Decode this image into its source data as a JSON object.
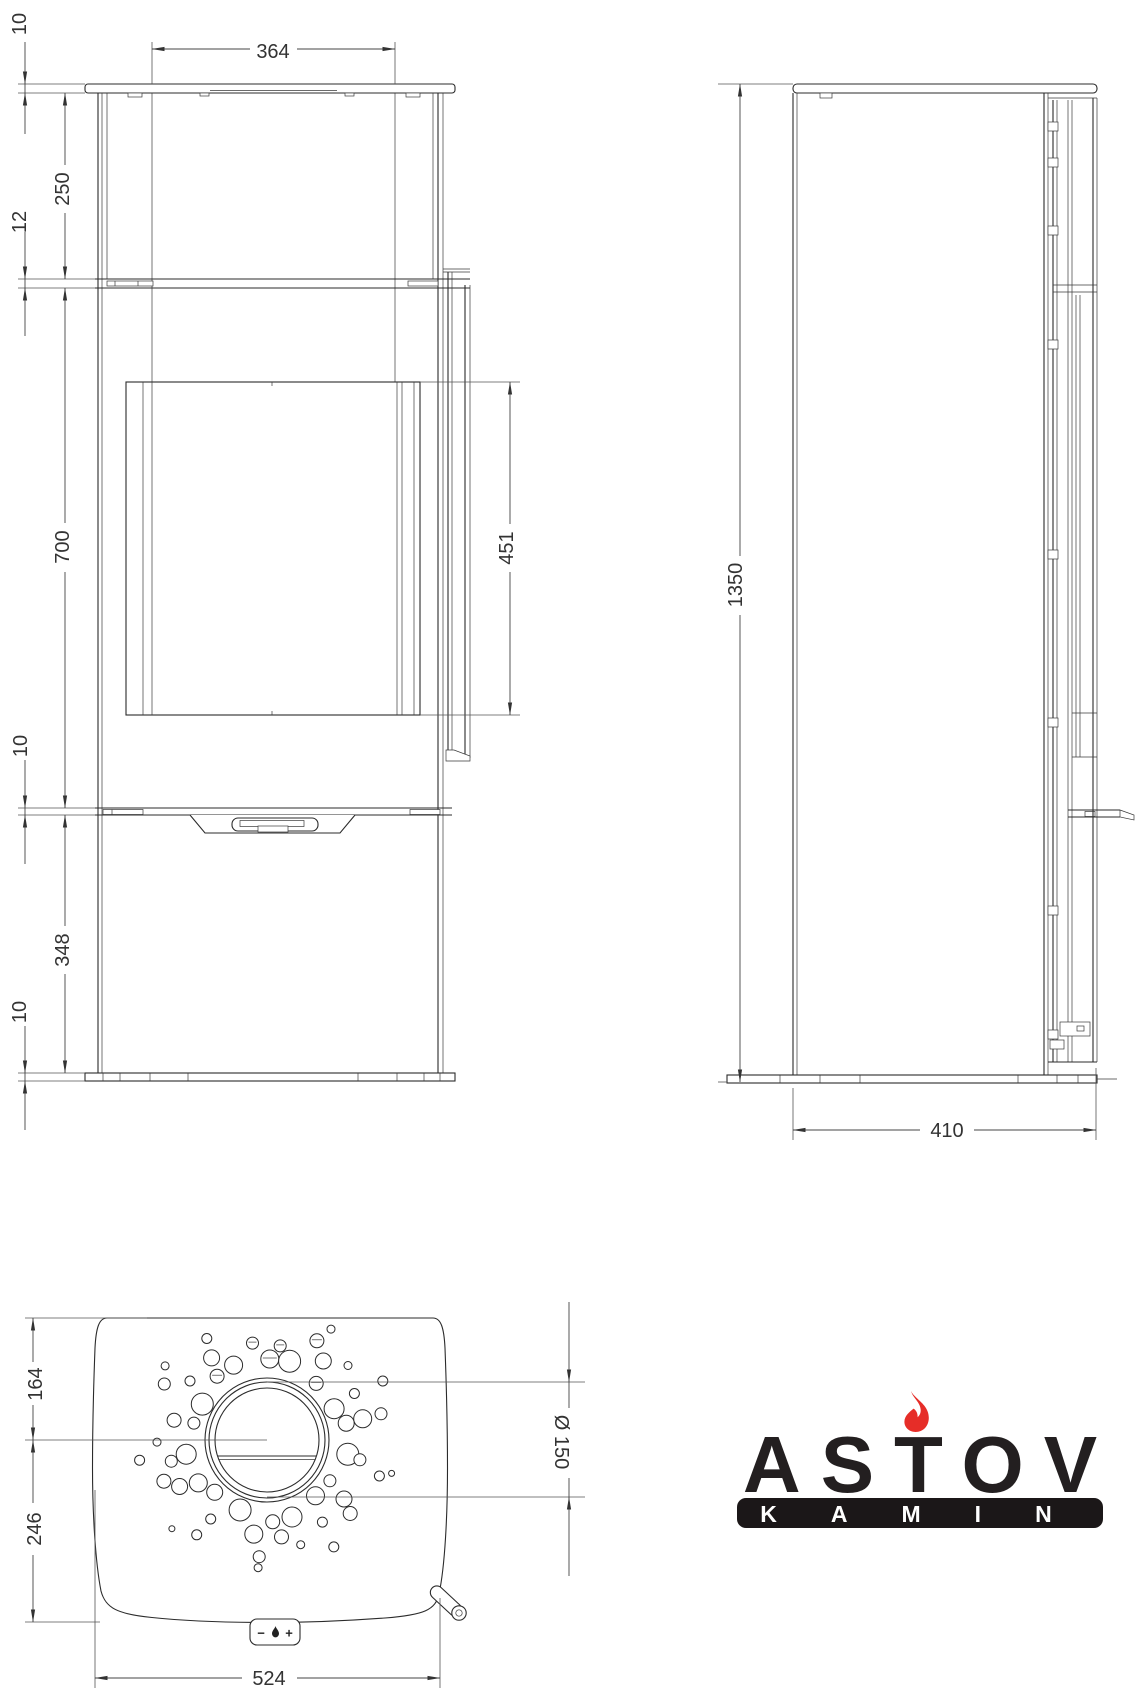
{
  "front": {
    "top_plate": "10",
    "upper": "250",
    "shelf": "12",
    "door": "700",
    "latch": "10",
    "lower": "348",
    "base": "10",
    "width": "364",
    "glass": "451"
  },
  "side": {
    "height": "1350",
    "depth": "410"
  },
  "top": {
    "front_to_center": "164",
    "center_to_back": "246",
    "width": "524",
    "flue": "Ø 150"
  },
  "logo": {
    "brand": "ASTOV",
    "sub": "KAMIN",
    "flame_color": "#e62d28",
    "text_color": "#231f20",
    "bar_color": "#1b1718"
  },
  "control": {
    "minus": "−",
    "plus": "+"
  }
}
